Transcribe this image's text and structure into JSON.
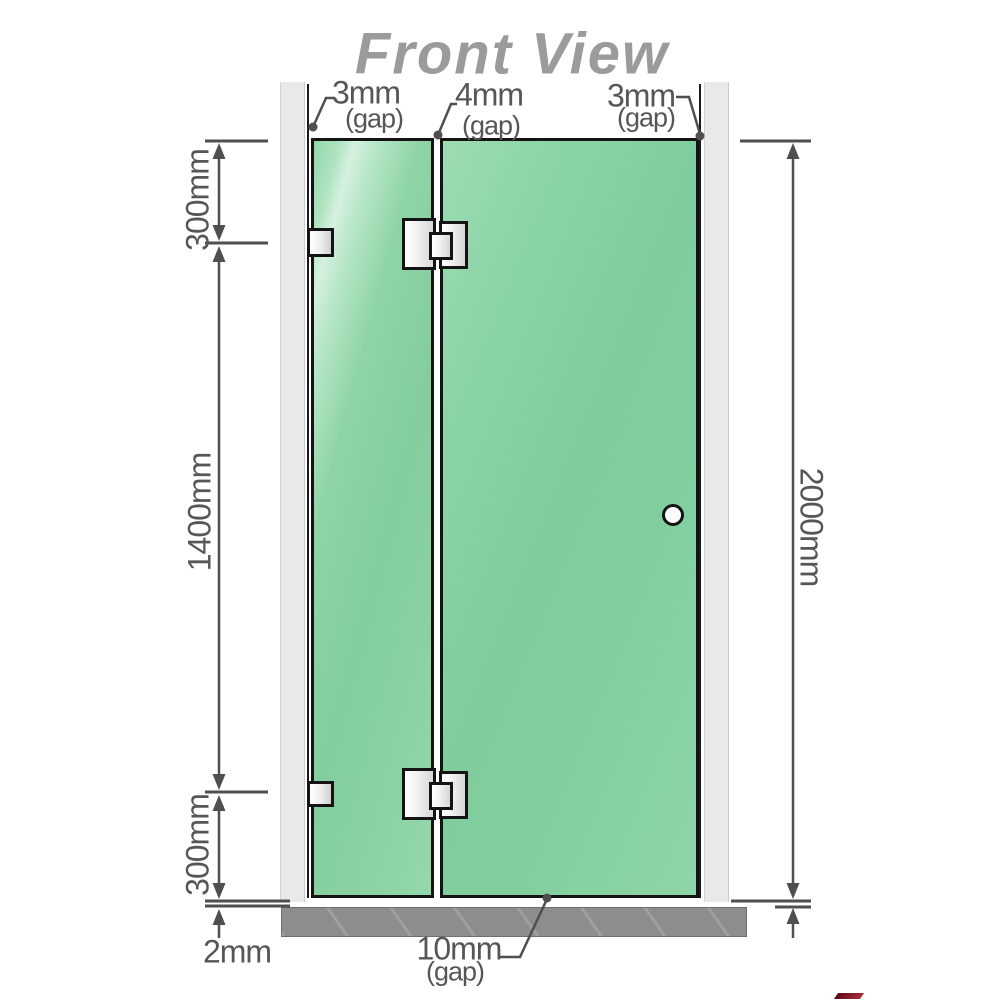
{
  "title": "Front View",
  "gaps": {
    "left": {
      "value": "3mm",
      "label": "(gap)"
    },
    "middle": {
      "value": "4mm",
      "label": "(gap)"
    },
    "right": {
      "value": "3mm",
      "label": "(gap)"
    },
    "bottom": {
      "value": "10mm",
      "label": "(gap)"
    }
  },
  "dimensions": {
    "top_left": "300mm",
    "mid_left": "1400mm",
    "bottom_left": "300mm",
    "right": "2000mm",
    "floor": "2mm"
  },
  "colors": {
    "glass_green": "#87d0a1",
    "glass_highlight": "#d6f1df",
    "wall_gray": "#e9e9e9",
    "floor_gray": "#8d8d8d",
    "line_gray": "#4f4f4f",
    "title_gray": "#9b9b9b",
    "outline_black": "#141414",
    "accent_red": "#8b1a2a"
  }
}
